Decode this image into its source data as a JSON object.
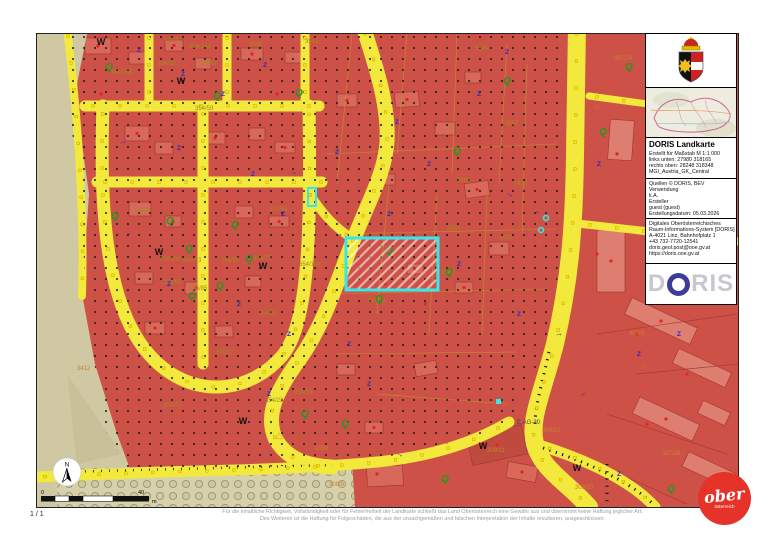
{
  "page": {
    "page_number": "1 / 1",
    "disclaimer_line1": "Für die inhaltliche Richtigkeit, Vollständigkeit oder für Fehlerfreiheit der Landkarte schließt das Land Oberösterreich eine Gewähr aus und übernimmt keine Haftung jeglicher Art.",
    "disclaimer_line2": "Des Weiteren ist die Haftung für Folgeschäden, die aus der unsachgemäßen und falschen Interpretation der Inhalte resultieren, ausgeschlossen."
  },
  "sidebar": {
    "title": "DORIS Landkarte",
    "meta": [
      "Erstellt für Maßstab M 1:1 000",
      "links unten: 27980 318165",
      "rechts oben: 28248 318348",
      "MGI_Austria_GK_Central"
    ],
    "source": [
      "Quellen © DORIS, BEV",
      "Verwendung",
      "k.A.",
      "Ersteller",
      "guest (guest)",
      "Erstellungsdatum: 05.03.2026"
    ],
    "contact": [
      "Digitales Oberösterreichisches",
      "Raum-Informations-System [DORIS]",
      "A-4021 Linz, Bahnhofplatz 1",
      "+43 732-7720-12541",
      "doris.geol.post@ooe.gv.at",
      "https://doris.ooe.gv.at"
    ],
    "logo_d": "D",
    "logo_ris": "RIS"
  },
  "footer_logo": {
    "line1": "ober",
    "line2": "österreich"
  },
  "map": {
    "north_label": "N",
    "scalebar": {
      "start": "0",
      "end": "40",
      "unit": "m"
    },
    "labels": [
      {
        "t": "354/61",
        "x": 127,
        "y": 8
      },
      {
        "t": "354/144",
        "x": 152,
        "y": 14
      },
      {
        "t": "3545",
        "x": 212,
        "y": 12
      },
      {
        "t": "3543",
        "x": 268,
        "y": 9
      },
      {
        "t": "3549",
        "x": 438,
        "y": 16
      },
      {
        "t": "354/57",
        "x": 162,
        "y": 31
      },
      {
        "t": "354/63",
        "x": 120,
        "y": 31
      },
      {
        "t": "354/59",
        "x": 158,
        "y": 76
      },
      {
        "t": "354/158",
        "x": 74,
        "y": 40
      },
      {
        "t": "354/91",
        "x": 96,
        "y": 178
      },
      {
        "t": "354/65",
        "x": 232,
        "y": 177
      },
      {
        "t": "354/100",
        "x": 122,
        "y": 227
      },
      {
        "t": "354/93",
        "x": 146,
        "y": 228
      },
      {
        "t": "354/83",
        "x": 184,
        "y": 228
      },
      {
        "t": "354/77",
        "x": 216,
        "y": 226
      },
      {
        "t": "354/95",
        "x": 126,
        "y": 250
      },
      {
        "t": "354/85",
        "x": 152,
        "y": 256
      },
      {
        "t": "354/81",
        "x": 222,
        "y": 281
      },
      {
        "t": "354/37",
        "x": 178,
        "y": 320
      },
      {
        "t": "354/27",
        "x": 126,
        "y": 373
      },
      {
        "t": "354/23",
        "x": 228,
        "y": 368
      },
      {
        "t": "354/73",
        "x": 257,
        "y": 360
      },
      {
        "t": "354/108",
        "x": 262,
        "y": 232
      },
      {
        "t": "354/19",
        "x": 330,
        "y": 268
      },
      {
        "t": "3564",
        "x": 410,
        "y": 196
      },
      {
        "t": "3565",
        "x": 420,
        "y": 148
      },
      {
        "t": "1422",
        "x": 477,
        "y": 151
      },
      {
        "t": "1421",
        "x": 462,
        "y": 205
      },
      {
        "t": "3567",
        "x": 468,
        "y": 91
      },
      {
        "t": "3546",
        "x": 404,
        "y": 240
      },
      {
        "t": "1392",
        "x": 278,
        "y": 416,
        "c": "g"
      },
      {
        "t": "309/9",
        "x": 292,
        "y": 452,
        "c": "g"
      },
      {
        "t": "309/11",
        "x": 450,
        "y": 418,
        "c": "g"
      },
      {
        "t": "309/12",
        "x": 505,
        "y": 398,
        "c": "g"
      },
      {
        "t": "309/20",
        "x": 538,
        "y": 455,
        "c": "g"
      },
      {
        "t": "E.AG-30",
        "x": 480,
        "y": 390,
        "c": "d"
      },
      {
        "t": "307/74",
        "x": 577,
        "y": 26,
        "c": "g"
      },
      {
        "t": "307/3",
        "x": 592,
        "y": 301,
        "c": "g"
      },
      {
        "t": "307/28",
        "x": 625,
        "y": 421,
        "c": "g"
      },
      {
        "t": "3412",
        "x": 40,
        "y": 336,
        "c": "g"
      }
    ],
    "symbols": {
      "W": [
        [
          64,
          11
        ],
        [
          144,
          50
        ],
        [
          122,
          221
        ],
        [
          226,
          235
        ],
        [
          206,
          390
        ],
        [
          446,
          415
        ],
        [
          540,
          437
        ]
      ],
      "Q": [
        [
          72,
          36
        ],
        [
          180,
          65
        ],
        [
          262,
          62
        ],
        [
          78,
          185
        ],
        [
          133,
          190
        ],
        [
          198,
          194
        ],
        [
          152,
          218
        ],
        [
          212,
          228
        ],
        [
          183,
          255
        ],
        [
          155,
          265
        ],
        [
          352,
          220
        ],
        [
          412,
          241
        ],
        [
          342,
          268
        ],
        [
          268,
          383
        ],
        [
          308,
          393
        ],
        [
          592,
          36
        ],
        [
          566,
          101
        ],
        [
          634,
          458
        ],
        [
          408,
          448
        ],
        [
          420,
          120
        ],
        [
          470,
          50
        ]
      ],
      "Z": [
        [
          102,
          18
        ],
        [
          146,
          42
        ],
        [
          228,
          33
        ],
        [
          186,
          62
        ],
        [
          142,
          116
        ],
        [
          216,
          142
        ],
        [
          246,
          182
        ],
        [
          132,
          252
        ],
        [
          202,
          272
        ],
        [
          252,
          302
        ],
        [
          312,
          312
        ],
        [
          352,
          182
        ],
        [
          392,
          132
        ],
        [
          422,
          232
        ],
        [
          332,
          352
        ],
        [
          232,
          362
        ],
        [
          442,
          62
        ],
        [
          482,
          282
        ],
        [
          562,
          132
        ],
        [
          602,
          322
        ],
        [
          642,
          302
        ],
        [
          582,
          442
        ],
        [
          470,
          20
        ],
        [
          360,
          90
        ],
        [
          300,
          120
        ]
      ],
      "arrow": [
        [
          92,
          202
        ],
        [
          302,
          202
        ],
        [
          472,
          162
        ],
        [
          522,
          302
        ],
        [
          362,
          422
        ],
        [
          86,
          110
        ],
        [
          256,
          140
        ],
        [
          546,
          362
        ],
        [
          612,
          252
        ],
        [
          500,
          180
        ]
      ],
      "triangle": [
        [
          242,
          404
        ]
      ],
      "ocircle": [
        [
          172,
          160
        ],
        [
          502,
          210
        ],
        [
          560,
          75
        ],
        [
          606,
          335
        ]
      ]
    }
  },
  "colors": {
    "selection": "#35e8ec",
    "road_yellow": "#f2e93c",
    "zone_red": "#ce5147",
    "field_beige": "#cfc8a2",
    "logo_red": "#e63329",
    "doris_blue": "#3c3c9a"
  }
}
